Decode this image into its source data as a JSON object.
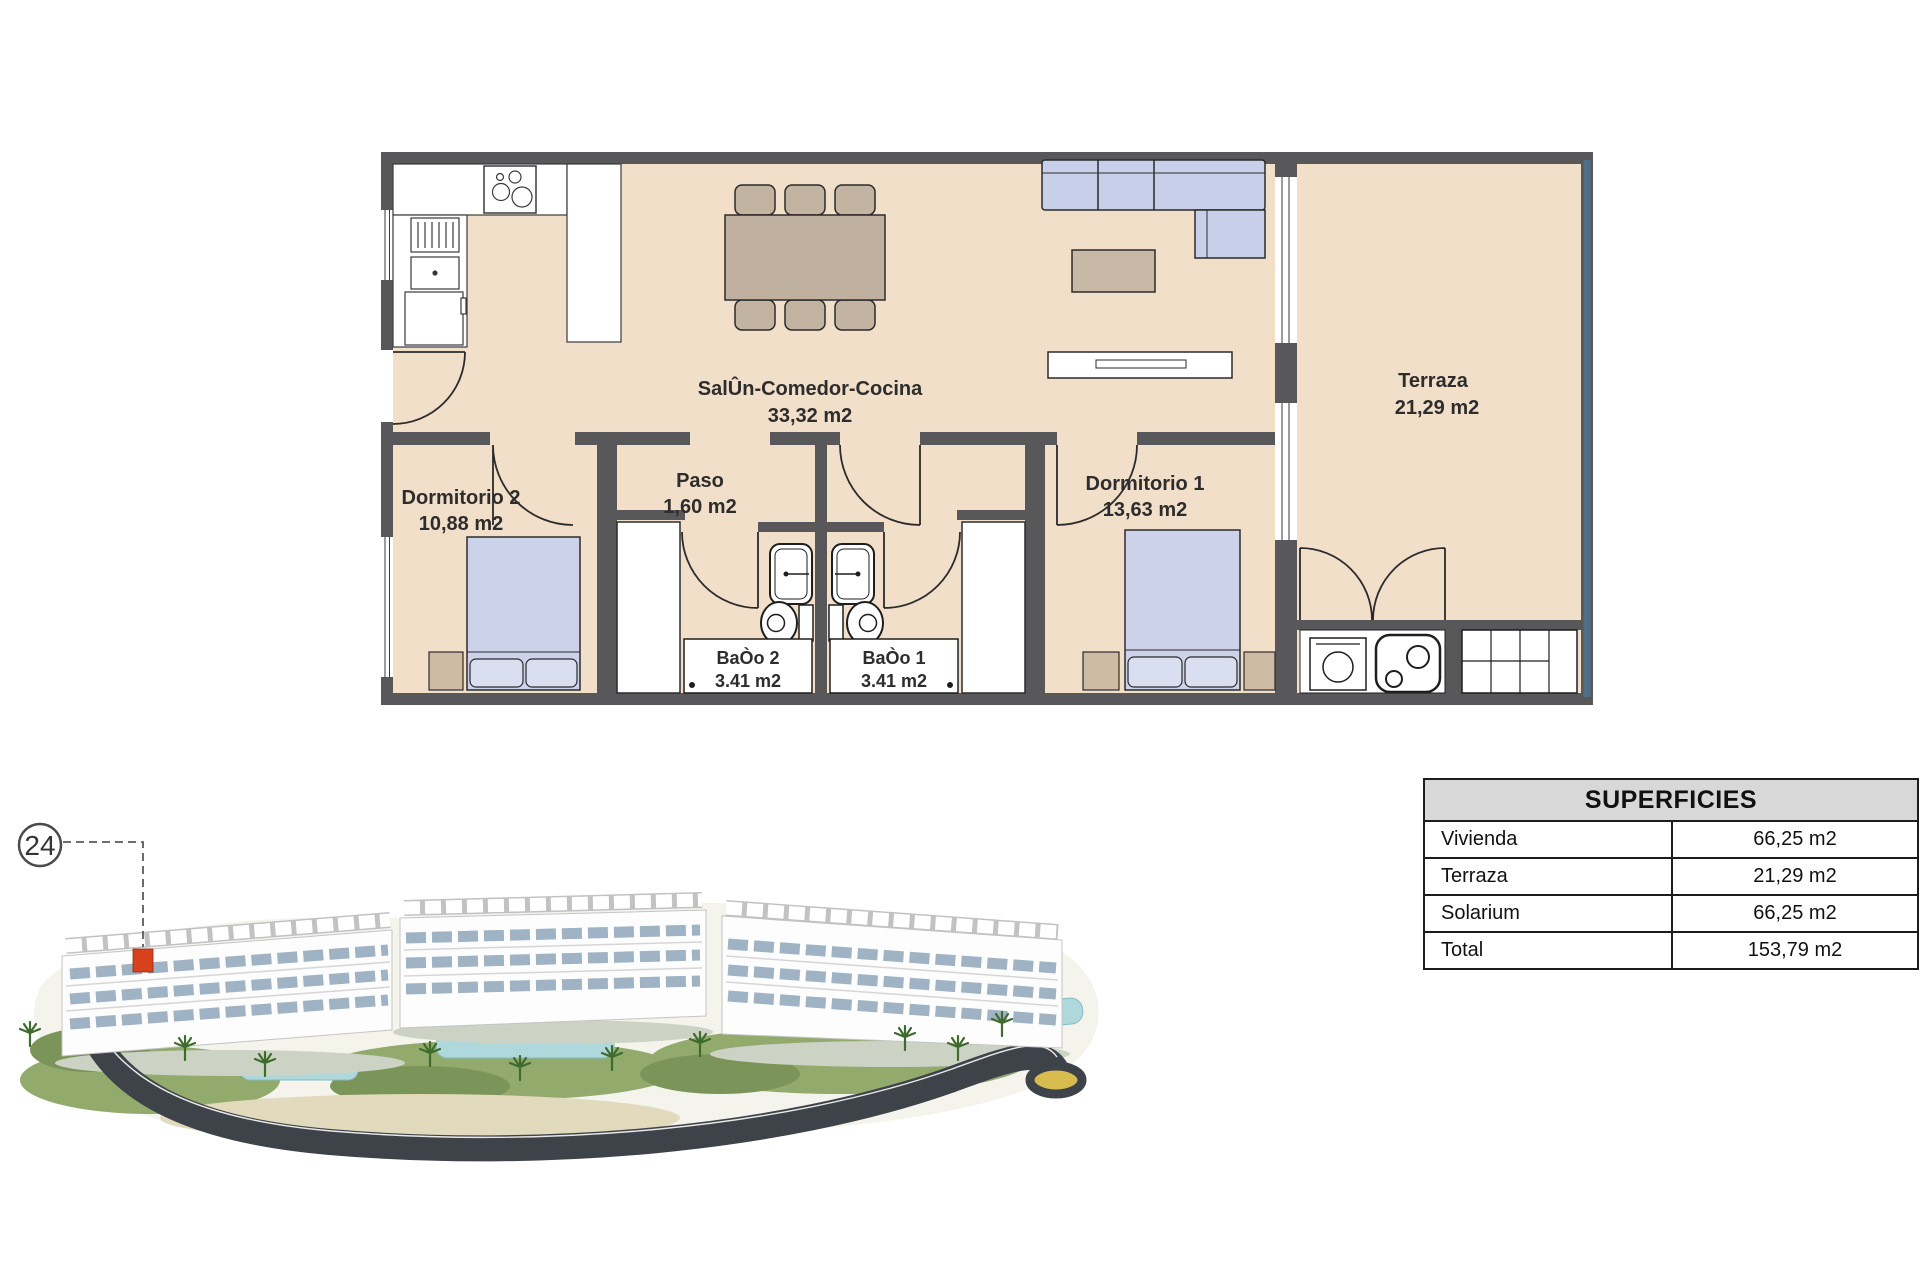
{
  "plan": {
    "rooms": {
      "salon": {
        "name": "SalÛn-Comedor-Cocina",
        "area": "33,32 m2"
      },
      "paso": {
        "name": "Paso",
        "area": "1,60 m2"
      },
      "dormitorio2": {
        "name": "Dormitorio 2",
        "area": "10,88 m2"
      },
      "dormitorio1": {
        "name": "Dormitorio 1",
        "area": "13,63 m2"
      },
      "terraza": {
        "name": "Terraza",
        "area": "21,29 m2"
      },
      "bano2": {
        "name": "BaÒo 2",
        "area": "3.41 m2"
      },
      "bano1": {
        "name": "BaÒo 1",
        "area": "3.41 m2"
      }
    },
    "colors": {
      "floor": "#F2DFC9",
      "wall": "#58585A",
      "furniture_blue": "#C8CFE8",
      "furniture_tan": "#BFB0A0",
      "railing": "#4F6E87"
    }
  },
  "render": {
    "unit_label": "24",
    "marker_color": "#D7411B"
  },
  "table": {
    "title": "SUPERFICIES",
    "rows": [
      {
        "label": "Vivienda",
        "value": "66,25 m2"
      },
      {
        "label": "Terraza",
        "value": "21,29 m2"
      },
      {
        "label": "Solarium",
        "value": "66,25 m2"
      },
      {
        "label": "Total",
        "value": "153,79 m2"
      }
    ]
  }
}
